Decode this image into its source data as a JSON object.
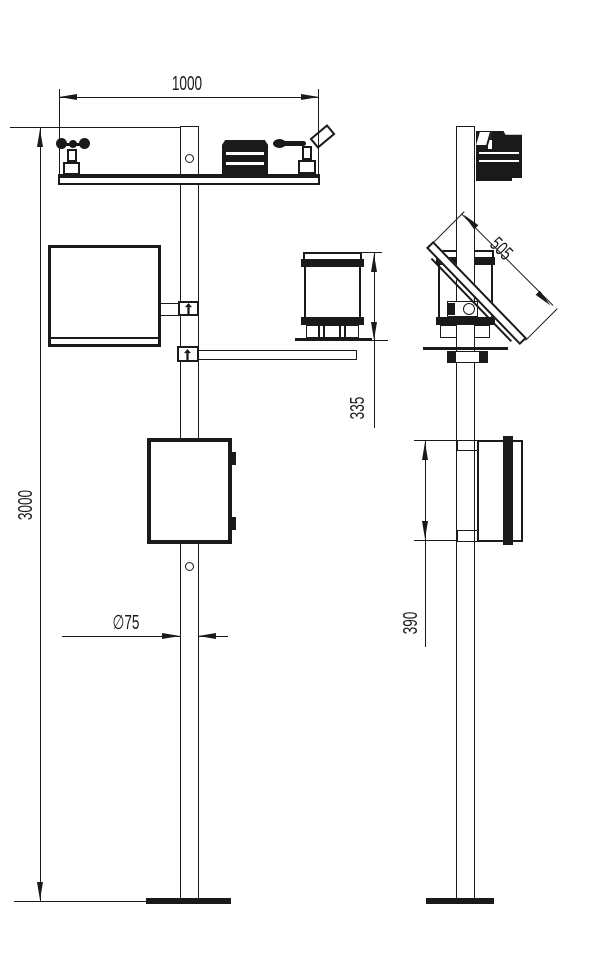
{
  "drawing": {
    "bg_color": "#ffffff",
    "line_color": "#1a1a1a",
    "dim_labels": {
      "crossarm_width": "1000",
      "mast_height": "3000",
      "rain_gauge_height": "335",
      "mast_diameter": "∅75",
      "solar_panel_length": "505",
      "enclosure_height": "390"
    }
  }
}
